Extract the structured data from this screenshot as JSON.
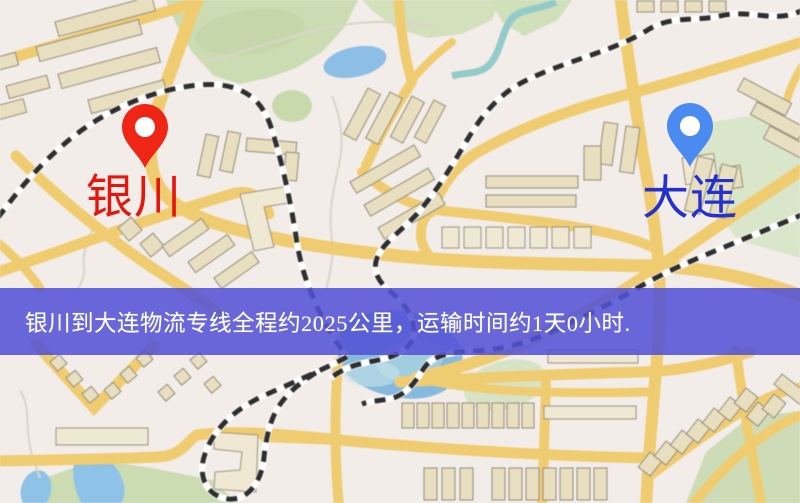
{
  "banner": {
    "text": "银川到大连物流专线全程约2025公里，运输时间约1天0小时.",
    "background_color": "#5351d4",
    "text_color": "#ffffff"
  },
  "markers": {
    "origin": {
      "label": "银川",
      "label_color": "#e8150d",
      "pin_color": "#ef2615",
      "pin_icon": "map-pin"
    },
    "destination": {
      "label": "大连",
      "label_color": "#2531cf",
      "pin_color": "#4b8af0",
      "pin_icon": "map-pin"
    }
  },
  "map": {
    "type": "street-map",
    "palette": {
      "background": "#f3edea",
      "road": "#f0cc70",
      "building": "#e8dec0",
      "park": "#cbdcb2",
      "water": "#8dbfe6",
      "railway": "#2e2e2e",
      "pond": "#8fc8cc"
    }
  }
}
